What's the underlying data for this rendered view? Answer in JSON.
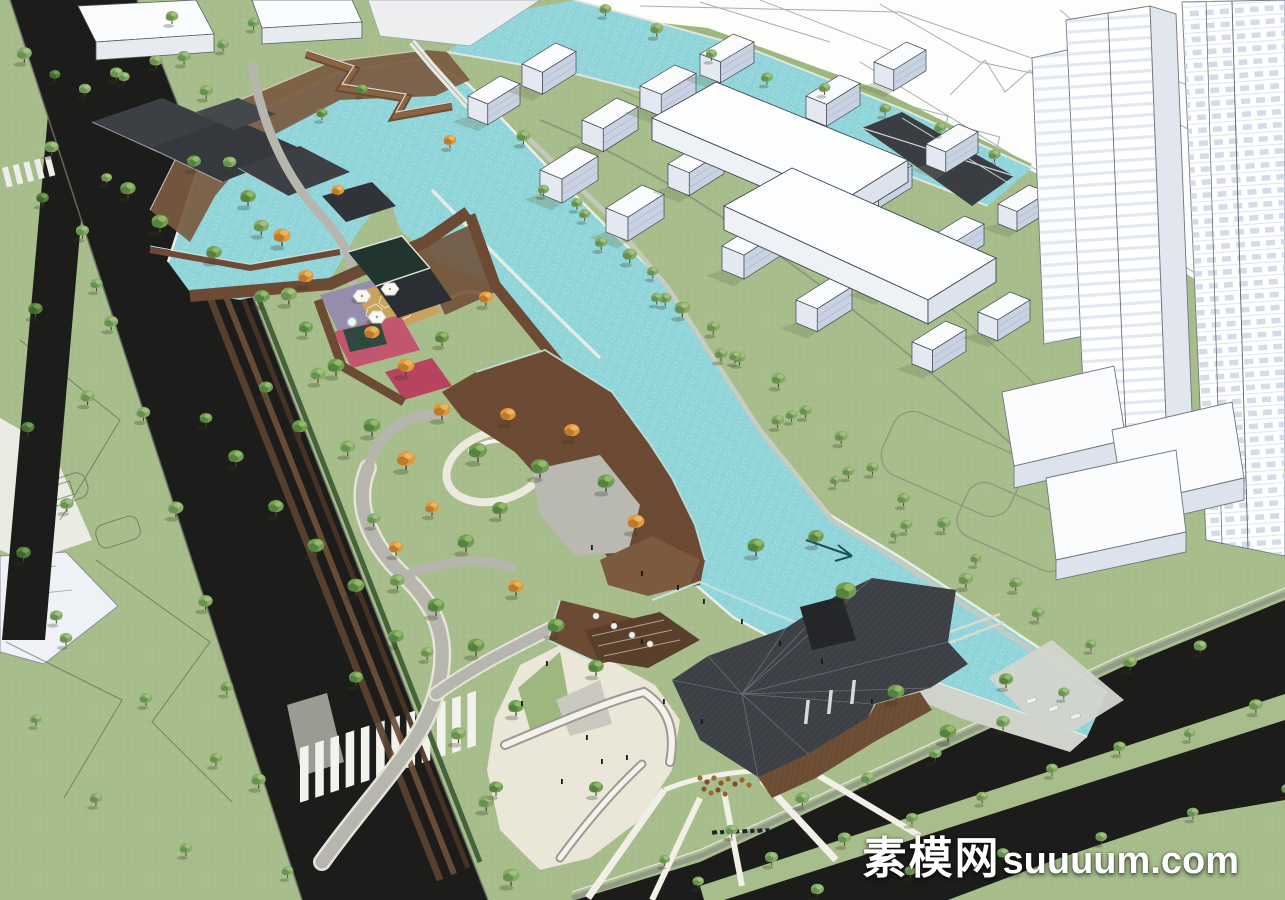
{
  "watermark": {
    "site_name": "素模网",
    "site_url": "suuuum.com"
  },
  "palette": {
    "lawn": "#a8bd8c",
    "lawn_dot": "#93a877",
    "water": "#8fd4d9",
    "road": "#1c1d1a",
    "sidewalk": "#9b9b94",
    "cad_white": "#fdfdfc",
    "plaza_beige": "#eae6d8",
    "path_gray": "#b6b6ae",
    "boardwalk": "#6d4a33",
    "deck_light": "#7b5a40",
    "roof_dark": "#3c3f44",
    "wood_wall": "#6f4e36",
    "paving_pink": "#c2566e",
    "paving_red": "#b8435f",
    "paving_purple": "#958dab",
    "paving_tan": "#c9a35e",
    "canopy_teal": "#22342e",
    "hedge": "#2e4a40",
    "building_white": "#fafbfd",
    "building_face": "#e4e9f1",
    "building_side": "#c9d2e2",
    "bank_edge": "#eceee6",
    "glass_rail": "#bfe4dd",
    "tree_trunk": "#5a4330"
  },
  "scene": {
    "tree_rows": [
      [
        172,
        24,
        516,
        880,
        13,
        1.05,
        "s"
      ],
      [
        20,
        60,
        290,
        880,
        10,
        0.95,
        "s"
      ],
      [
        50,
        80,
        20,
        560,
        5,
        0.9,
        "d"
      ],
      [
        112,
        80,
        62,
        620,
        6,
        0.9,
        "s"
      ],
      [
        85,
        100,
        258,
        34,
        6,
        0.9,
        "s"
      ],
      [
        600,
        20,
        1000,
        160,
        8,
        0.85,
        "s"
      ],
      [
        524,
        150,
        960,
        586,
        9,
        0.95,
        "s"
      ],
      [
        590,
        215,
        1035,
        618,
        8,
        0.9,
        "s"
      ],
      [
        668,
        305,
        1085,
        648,
        7,
        0.85,
        "s"
      ],
      [
        548,
        192,
        890,
        542,
        7,
        0.8,
        "s"
      ],
      [
        668,
        866,
        1195,
        648,
        9,
        0.9,
        "s"
      ],
      [
        700,
        890,
        1258,
        712,
        9,
        0.9,
        "s"
      ],
      [
        812,
        898,
        1285,
        800,
        6,
        0.85,
        "s"
      ]
    ],
    "tree_clusters": [
      [
        128,
        198,
        1.1,
        "g"
      ],
      [
        160,
        232,
        1.2,
        "g"
      ],
      [
        194,
        170,
        1.0,
        "g"
      ],
      [
        214,
        262,
        1.1,
        "g"
      ],
      [
        248,
        206,
        1.1,
        "g"
      ],
      [
        282,
        246,
        1.2,
        "a"
      ],
      [
        262,
        306,
        1.1,
        "g"
      ],
      [
        306,
        286,
        1.1,
        "a"
      ],
      [
        338,
        198,
        0.9,
        "a"
      ],
      [
        306,
        336,
        1.0,
        "g"
      ],
      [
        336,
        376,
        1.2,
        "g"
      ],
      [
        372,
        342,
        1.1,
        "a"
      ],
      [
        406,
        376,
        1.2,
        "a"
      ],
      [
        442,
        346,
        1.0,
        "g"
      ],
      [
        372,
        436,
        1.2,
        "g"
      ],
      [
        406,
        470,
        1.3,
        "a"
      ],
      [
        442,
        420,
        1.2,
        "a"
      ],
      [
        478,
        462,
        1.3,
        "g"
      ],
      [
        508,
        424,
        1.1,
        "a"
      ],
      [
        540,
        478,
        1.3,
        "g"
      ],
      [
        572,
        440,
        1.1,
        "a"
      ],
      [
        606,
        492,
        1.2,
        "g"
      ],
      [
        636,
        532,
        1.2,
        "a"
      ],
      [
        500,
        518,
        1.1,
        "g"
      ],
      [
        466,
        552,
        1.2,
        "g"
      ],
      [
        432,
        516,
        1.0,
        "a"
      ],
      [
        300,
        436,
        1.1,
        "g"
      ],
      [
        266,
        396,
        1.0,
        "g"
      ],
      [
        236,
        466,
        1.1,
        "g"
      ],
      [
        206,
        426,
        0.9,
        "g"
      ],
      [
        276,
        516,
        1.1,
        "g"
      ],
      [
        316,
        556,
        1.2,
        "g"
      ],
      [
        356,
        596,
        1.2,
        "g"
      ],
      [
        396,
        556,
        1.0,
        "a"
      ],
      [
        436,
        616,
        1.2,
        "g"
      ],
      [
        476,
        656,
        1.2,
        "g"
      ],
      [
        396,
        646,
        1.1,
        "g"
      ],
      [
        356,
        686,
        1.0,
        "g"
      ],
      [
        516,
        596,
        1.1,
        "a"
      ],
      [
        556,
        636,
        1.2,
        "g"
      ],
      [
        596,
        676,
        1.1,
        "g"
      ],
      [
        516,
        716,
        1.1,
        "g"
      ],
      [
        496,
        796,
        1.0,
        "g"
      ],
      [
        596,
        796,
        1.0,
        "g"
      ],
      [
        756,
        556,
        1.2,
        "g"
      ],
      [
        816,
        546,
        1.1,
        "g"
      ],
      [
        846,
        604,
        1.5,
        "g"
      ],
      [
        896,
        702,
        1.2,
        "g"
      ],
      [
        948,
        742,
        1.2,
        "g"
      ],
      [
        1006,
        688,
        1.0,
        "g"
      ],
      [
        322,
        120,
        0.8,
        "g"
      ],
      [
        362,
        96,
        0.8,
        "g"
      ],
      [
        450,
        148,
        0.9,
        "a"
      ],
      [
        486,
        306,
        1.0,
        "a"
      ],
      [
        66,
        646,
        0.9,
        "s"
      ],
      [
        146,
        706,
        0.9,
        "s"
      ],
      [
        216,
        766,
        0.9,
        "s"
      ],
      [
        96,
        806,
        0.9,
        "s"
      ],
      [
        186,
        856,
        0.9,
        "s"
      ],
      [
        36,
        726,
        0.8,
        "s"
      ]
    ],
    "people": [
      [
        613,
        621
      ],
      [
        641,
        639
      ],
      [
        703,
        599
      ],
      [
        741,
        619
      ],
      [
        779,
        641
      ],
      [
        821,
        659
      ],
      [
        601,
        759
      ],
      [
        561,
        779
      ],
      [
        663,
        699
      ],
      [
        701,
        719
      ],
      [
        871,
        699
      ],
      [
        641,
        571
      ],
      [
        677,
        585
      ],
      [
        591,
        545
      ],
      [
        546,
        661
      ],
      [
        521,
        701
      ],
      [
        586,
        735
      ],
      [
        626,
        755
      ]
    ],
    "umbrellas": [
      [
        362,
        296
      ],
      [
        390,
        289
      ],
      [
        377,
        317
      ]
    ],
    "cafe_tables": [
      [
        596,
        616
      ],
      [
        614,
        626
      ],
      [
        632,
        635
      ],
      [
        650,
        644
      ]
    ],
    "deck_chairs": [
      [
        1026,
        700
      ],
      [
        1048,
        708
      ],
      [
        1070,
        716
      ]
    ],
    "white_buildings": [
      [
        468,
        96,
        52,
        40
      ],
      [
        522,
        64,
        54,
        42
      ],
      [
        582,
        120,
        56,
        44
      ],
      [
        640,
        86,
        56,
        42
      ],
      [
        700,
        54,
        54,
        40
      ],
      [
        540,
        170,
        58,
        46
      ],
      [
        606,
        208,
        58,
        46
      ],
      [
        668,
        164,
        56,
        44
      ],
      [
        736,
        130,
        56,
        42
      ],
      [
        806,
        96,
        54,
        42
      ],
      [
        874,
        62,
        52,
        40
      ],
      [
        722,
        246,
        58,
        46
      ],
      [
        790,
        212,
        56,
        44
      ],
      [
        858,
        178,
        54,
        42
      ],
      [
        926,
        144,
        52,
        40
      ],
      [
        796,
        300,
        56,
        44
      ],
      [
        864,
        268,
        54,
        42
      ],
      [
        932,
        236,
        52,
        40
      ],
      [
        998,
        204,
        50,
        38
      ],
      [
        912,
        342,
        54,
        42
      ],
      [
        978,
        312,
        52,
        40
      ]
    ]
  }
}
